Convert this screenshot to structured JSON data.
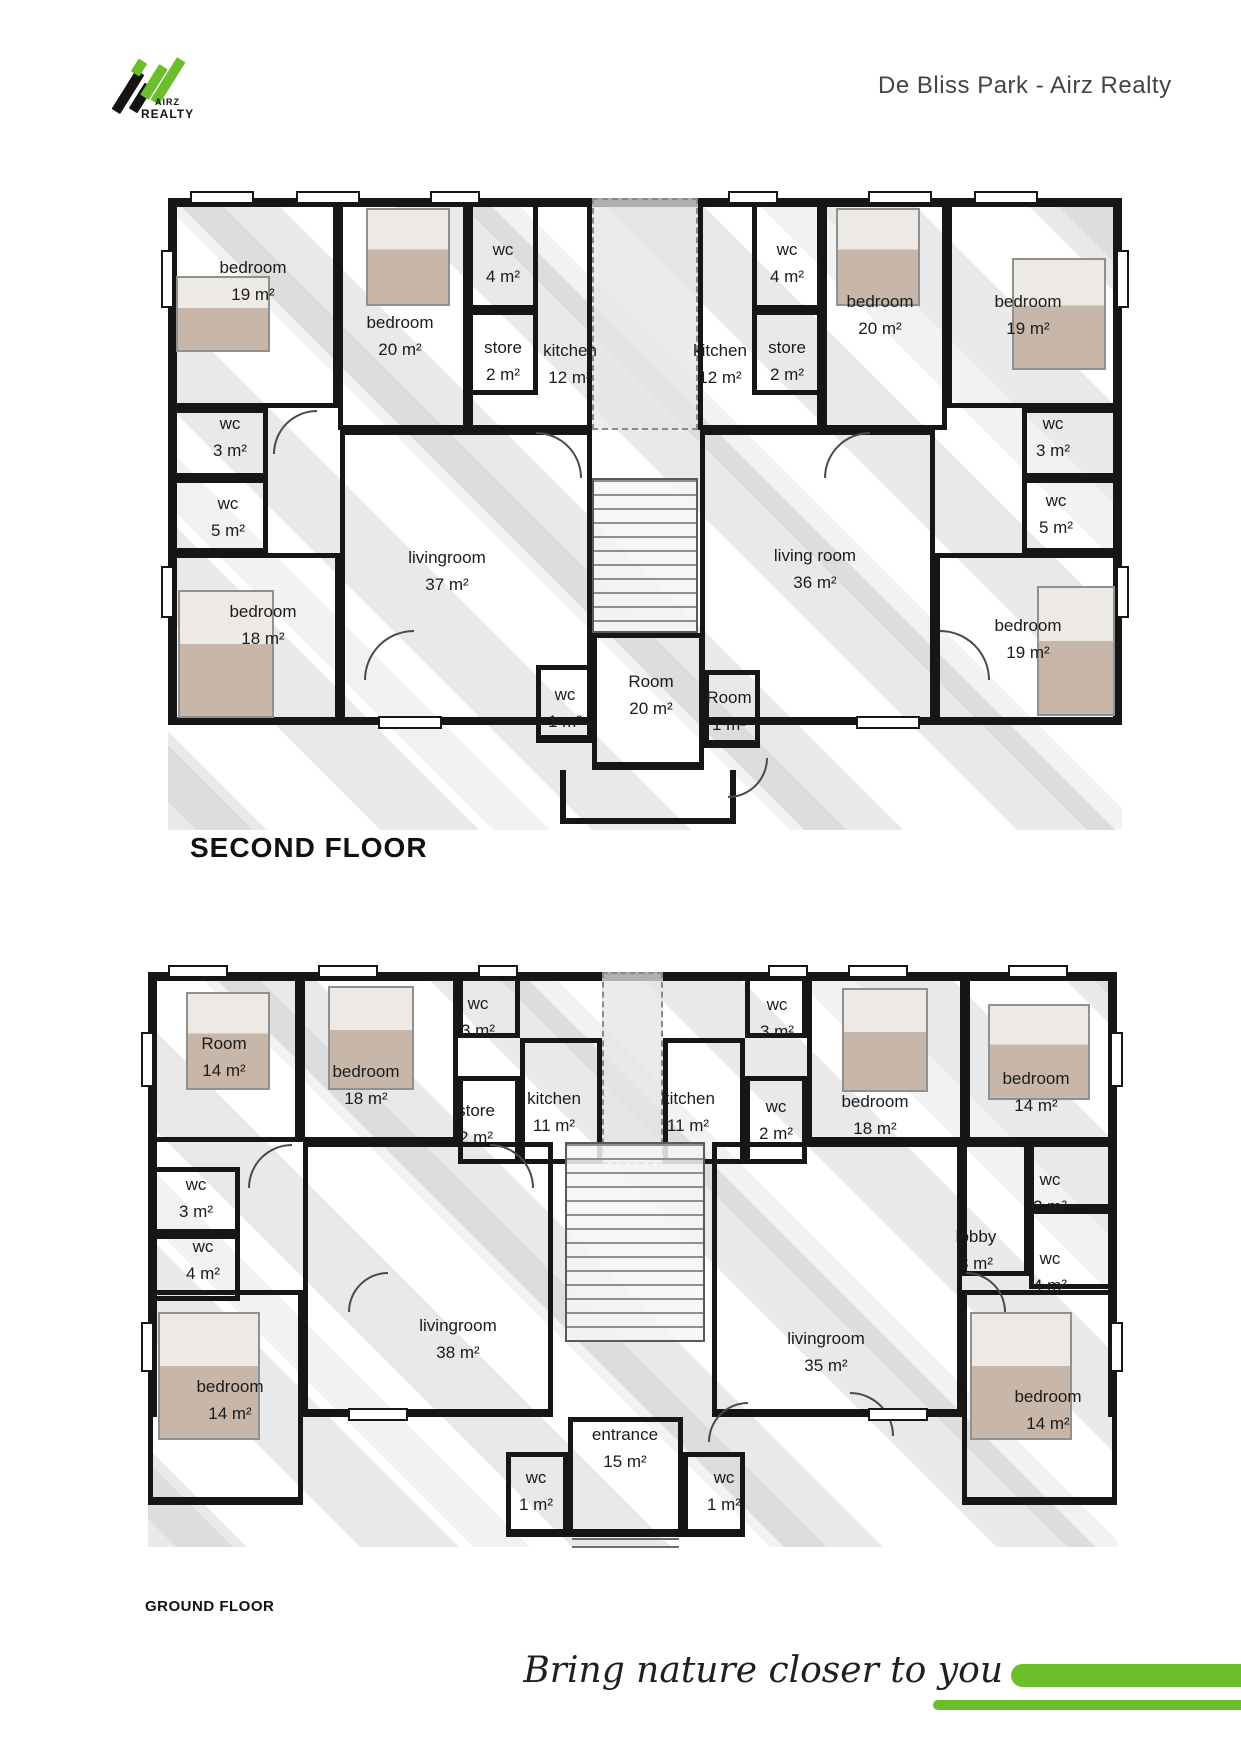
{
  "header": {
    "logo_line1": "AIRZ",
    "logo_line2": "REALTY",
    "title": "De Bliss Park - Airz Realty"
  },
  "footer": {
    "tagline": "Bring nature closer to you"
  },
  "colors": {
    "accent_green": "#6cbe2b",
    "wall_black": "#161616",
    "shadow_gray": "#d9d9d9",
    "bed_tan": "#c8b7a8"
  },
  "floors": [
    {
      "caption": "SECOND FLOOR",
      "outline": [
        0,
        0,
        954,
        527
      ],
      "features": [
        {
          "type": "shaft",
          "rect": [
            424,
            0,
            106,
            232
          ]
        },
        {
          "type": "staircase",
          "rect": [
            424,
            280,
            106,
            155
          ]
        },
        {
          "type": "porch",
          "rect": [
            392,
            572,
            176,
            54
          ]
        }
      ],
      "rooms": [
        {
          "id": "bedroom-19-tl",
          "name": "bedroom",
          "area": "19 m²",
          "rect": [
            0,
            0,
            170,
            210
          ],
          "label": [
            85,
            83
          ],
          "bed": [
            8,
            78,
            94,
            76
          ]
        },
        {
          "id": "bedroom-20-l",
          "name": "bedroom",
          "area": "20 m²",
          "rect": [
            170,
            0,
            130,
            232
          ],
          "label": [
            232,
            138
          ],
          "bed": [
            198,
            10,
            84,
            98
          ]
        },
        {
          "id": "kitchen-12-l",
          "name": "kitchen",
          "area": "12 m²",
          "rect": [
            300,
            0,
            124,
            232
          ],
          "label": [
            402,
            166
          ]
        },
        {
          "id": "wc-4-l",
          "name": "wc",
          "area": "4 m²",
          "rect": [
            300,
            0,
            70,
            112
          ],
          "label": [
            335,
            65
          ]
        },
        {
          "id": "store-2-l",
          "name": "store",
          "area": "2 m²",
          "rect": [
            300,
            112,
            70,
            85
          ],
          "label": [
            335,
            163
          ]
        },
        {
          "id": "kitchen-12-r",
          "name": "kitchen",
          "area": "12 m²",
          "rect": [
            530,
            0,
            124,
            232
          ],
          "label": [
            552,
            166
          ]
        },
        {
          "id": "wc-4-r",
          "name": "wc",
          "area": "4 m²",
          "rect": [
            584,
            0,
            70,
            112
          ],
          "label": [
            619,
            65
          ]
        },
        {
          "id": "store-2-r",
          "name": "store",
          "area": "2 m²",
          "rect": [
            584,
            112,
            70,
            85
          ],
          "label": [
            619,
            163
          ]
        },
        {
          "id": "bedroom-20-r",
          "name": "bedroom",
          "area": "20 m²",
          "rect": [
            654,
            0,
            125,
            232
          ],
          "label": [
            712,
            117
          ],
          "bed": [
            668,
            10,
            84,
            98
          ]
        },
        {
          "id": "bedroom-19-tr",
          "name": "bedroom",
          "area": "19 m²",
          "rect": [
            779,
            0,
            175,
            210
          ],
          "label": [
            860,
            117
          ],
          "bed": [
            844,
            60,
            94,
            112
          ]
        },
        {
          "id": "wc-3-l",
          "name": "wc",
          "area": "3 m²",
          "rect": [
            0,
            210,
            100,
            70
          ],
          "label": [
            62,
            239
          ]
        },
        {
          "id": "wc-5-l",
          "name": "wc",
          "area": "5 m²",
          "rect": [
            0,
            280,
            100,
            75
          ],
          "label": [
            60,
            319
          ]
        },
        {
          "id": "bedroom-18-l",
          "name": "bedroom",
          "area": "18 m²",
          "rect": [
            0,
            355,
            172,
            172
          ],
          "label": [
            95,
            427
          ],
          "bed": [
            10,
            392,
            96,
            128
          ]
        },
        {
          "id": "livingroom-37",
          "name": "livingroom",
          "area": "37 m²",
          "rect": [
            172,
            232,
            252,
            295
          ],
          "label": [
            279,
            373
          ]
        },
        {
          "id": "wc-1-l",
          "name": "wc",
          "area": "1 m²",
          "rect": [
            368,
            467,
            56,
            78
          ],
          "label": [
            397,
            510
          ]
        },
        {
          "id": "room-20-core",
          "name": "Room",
          "area": "20 m²",
          "rect": [
            424,
            435,
            112,
            137
          ],
          "label": [
            483,
            497
          ]
        },
        {
          "id": "room-1-core",
          "name": "Room",
          "area": "1 m²",
          "rect": [
            536,
            472,
            56,
            78
          ],
          "label": [
            561,
            513
          ]
        },
        {
          "id": "living-room-36",
          "name": "living room",
          "area": "36 m²",
          "rect": [
            532,
            232,
            235,
            295
          ],
          "label": [
            647,
            371
          ]
        },
        {
          "id": "bedroom-19-br",
          "name": "bedroom",
          "area": "19 m²",
          "rect": [
            767,
            355,
            187,
            172
          ],
          "label": [
            860,
            441
          ],
          "bed": [
            869,
            388,
            78,
            130
          ]
        },
        {
          "id": "wc-3-r",
          "name": "wc",
          "area": "3 m²",
          "rect": [
            854,
            210,
            100,
            70
          ],
          "label": [
            885,
            239
          ]
        },
        {
          "id": "wc-5-r",
          "name": "wc",
          "area": "5 m²",
          "rect": [
            854,
            280,
            100,
            75
          ],
          "label": [
            888,
            316
          ]
        }
      ]
    },
    {
      "caption": "GROUND FLOOR",
      "outline": [
        0,
        0,
        969,
        445
      ],
      "features": [
        {
          "type": "shaft",
          "rect": [
            454,
            0,
            61,
            192
          ]
        },
        {
          "type": "staircase",
          "rect": [
            417,
            170,
            140,
            200
          ]
        },
        {
          "type": "steps",
          "rect": [
            424,
            558,
            107,
            22
          ]
        }
      ],
      "rooms": [
        {
          "id": "room-14",
          "name": "Room",
          "area": "14 m²",
          "rect": [
            0,
            0,
            152,
            170
          ],
          "label": [
            76,
            85
          ],
          "bed": [
            38,
            20,
            84,
            98
          ]
        },
        {
          "id": "bedroom-18-l",
          "name": "bedroom",
          "area": "18 m²",
          "rect": [
            152,
            0,
            158,
            170
          ],
          "label": [
            218,
            113
          ],
          "bed": [
            180,
            14,
            86,
            104
          ]
        },
        {
          "id": "wc-3-l-top",
          "name": "wc",
          "area": "3 m²",
          "rect": [
            310,
            0,
            62,
            66
          ],
          "label": [
            330,
            45
          ]
        },
        {
          "id": "store-2-l",
          "name": "store",
          "area": "2 m²",
          "rect": [
            310,
            104,
            62,
            88
          ],
          "label": [
            328,
            152
          ]
        },
        {
          "id": "kitchen-11-l",
          "name": "kitchen",
          "area": "11 m²",
          "rect": [
            372,
            66,
            82,
            126
          ],
          "label": [
            406,
            140
          ]
        },
        {
          "id": "kitchen-11-r",
          "name": "kitchen",
          "area": "11 m²",
          "rect": [
            515,
            66,
            82,
            126
          ],
          "label": [
            540,
            140
          ]
        },
        {
          "id": "wc-3-r-top",
          "name": "wc",
          "area": "3 m²",
          "rect": [
            597,
            0,
            62,
            66
          ],
          "label": [
            629,
            46
          ]
        },
        {
          "id": "wc-2-r-top",
          "name": "wc",
          "area": "2 m²",
          "rect": [
            597,
            104,
            62,
            88
          ],
          "label": [
            628,
            148
          ]
        },
        {
          "id": "bedroom-18-r",
          "name": "bedroom",
          "area": "18 m²",
          "rect": [
            659,
            0,
            158,
            170
          ],
          "label": [
            727,
            143
          ],
          "bed": [
            694,
            16,
            86,
            104
          ]
        },
        {
          "id": "bedroom-14-tr",
          "name": "bedroom",
          "area": "14 m²",
          "rect": [
            817,
            0,
            152,
            170
          ],
          "label": [
            888,
            120
          ],
          "bed": [
            840,
            32,
            102,
            96
          ]
        },
        {
          "id": "wc-3-l-side",
          "name": "wc",
          "area": "3 m²",
          "rect": [
            0,
            195,
            92,
            67
          ],
          "label": [
            48,
            226
          ]
        },
        {
          "id": "wc-4-l-side",
          "name": "wc",
          "area": "4 m²",
          "rect": [
            0,
            262,
            92,
            67
          ],
          "label": [
            55,
            288
          ]
        },
        {
          "id": "bedroom-14-bl",
          "name": "bedroom",
          "area": "14 m²",
          "rect": [
            0,
            318,
            155,
            215
          ],
          "label": [
            82,
            428
          ],
          "bed": [
            10,
            340,
            102,
            128
          ]
        },
        {
          "id": "livingroom-38",
          "name": "livingroom",
          "area": "38 m²",
          "rect": [
            155,
            170,
            250,
            275
          ],
          "label": [
            310,
            367
          ]
        },
        {
          "id": "livingroom-35",
          "name": "livingroom",
          "area": "35 m²",
          "rect": [
            564,
            170,
            250,
            275
          ],
          "label": [
            678,
            380
          ]
        },
        {
          "id": "lobby-3",
          "name": "lobby",
          "area": "3 m²",
          "rect": [
            814,
            170,
            67,
            134
          ],
          "label": [
            828,
            278
          ]
        },
        {
          "id": "wc-2-r-side",
          "name": "wc",
          "area": "2 m²",
          "rect": [
            881,
            170,
            88,
            67
          ],
          "label": [
            902,
            221
          ]
        },
        {
          "id": "wc-4-r-side",
          "name": "wc",
          "area": "4 m²",
          "rect": [
            881,
            237,
            88,
            80
          ],
          "label": [
            902,
            300
          ]
        },
        {
          "id": "bedroom-14-br",
          "name": "bedroom",
          "area": "14 m²",
          "rect": [
            814,
            318,
            155,
            215
          ],
          "label": [
            900,
            438
          ],
          "bed": [
            822,
            340,
            102,
            128
          ]
        },
        {
          "id": "wc-1-l",
          "name": "wc",
          "area": "1 m²",
          "rect": [
            358,
            480,
            62,
            85
          ],
          "label": [
            388,
            519
          ]
        },
        {
          "id": "entrance-15",
          "name": "entrance",
          "area": "15 m²",
          "rect": [
            420,
            445,
            115,
            120
          ],
          "label": [
            477,
            476
          ]
        },
        {
          "id": "wc-1-r",
          "name": "wc",
          "area": "1 m²",
          "rect": [
            535,
            480,
            62,
            85
          ],
          "label": [
            576,
            519
          ]
        }
      ]
    }
  ]
}
